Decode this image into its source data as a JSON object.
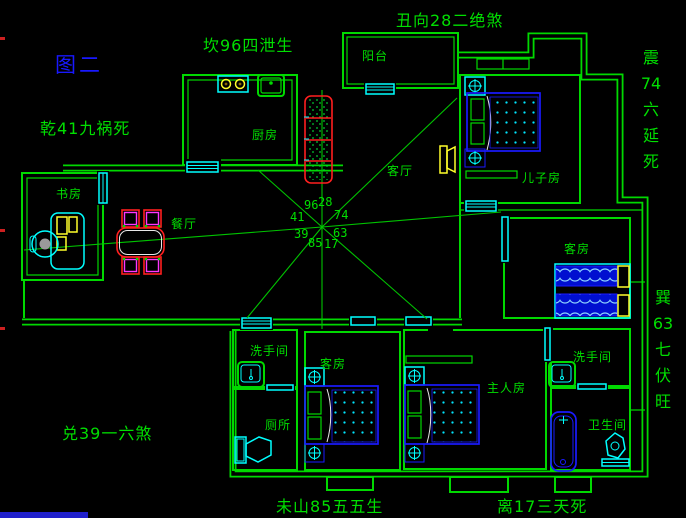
{
  "figure_label": "图二",
  "annotations": {
    "top_left": "坎96四泄生",
    "top_center": "丑向28二绝煞",
    "left": "乾41九祸死",
    "bottom_left": "兑39一六煞",
    "bottom_center_left": "未山85五五生",
    "bottom_center_right": "离17三天死",
    "right_upper": [
      "震",
      "74",
      "六",
      "延",
      "死"
    ],
    "right_lower": [
      "巽",
      "63",
      "七",
      "伏",
      "旺"
    ]
  },
  "rooms": {
    "balcony": "阳台",
    "kitchen": "厨房",
    "living_room": "客厅",
    "sons_room": "儿子房",
    "study": "书房",
    "dining_room": "餐厅",
    "guest_room_mid": "客房",
    "washroom_left": "洗手间",
    "toilet": "厕所",
    "guest_room_bottom": "客房",
    "master_bedroom": "主人房",
    "washroom_right": "洗手间",
    "bathroom": "卫生间"
  },
  "compass": {
    "numbers": {
      "nnw": "96",
      "nne": "28",
      "wnw": "41",
      "ene": "74",
      "wsw": "39",
      "ese": "63",
      "ssw": "85",
      "sse": "17"
    }
  },
  "colors": {
    "background": "#000000",
    "wall_green": "#00d900",
    "text_green": "#00df00",
    "window_cyan": "#00ffff",
    "furniture_blue": "#1a1aff",
    "accent_red": "#ff1f1f",
    "accent_magenta": "#ff35ff",
    "accent_yellow": "#ffff2a",
    "figure_blue": "#1818ff"
  }
}
